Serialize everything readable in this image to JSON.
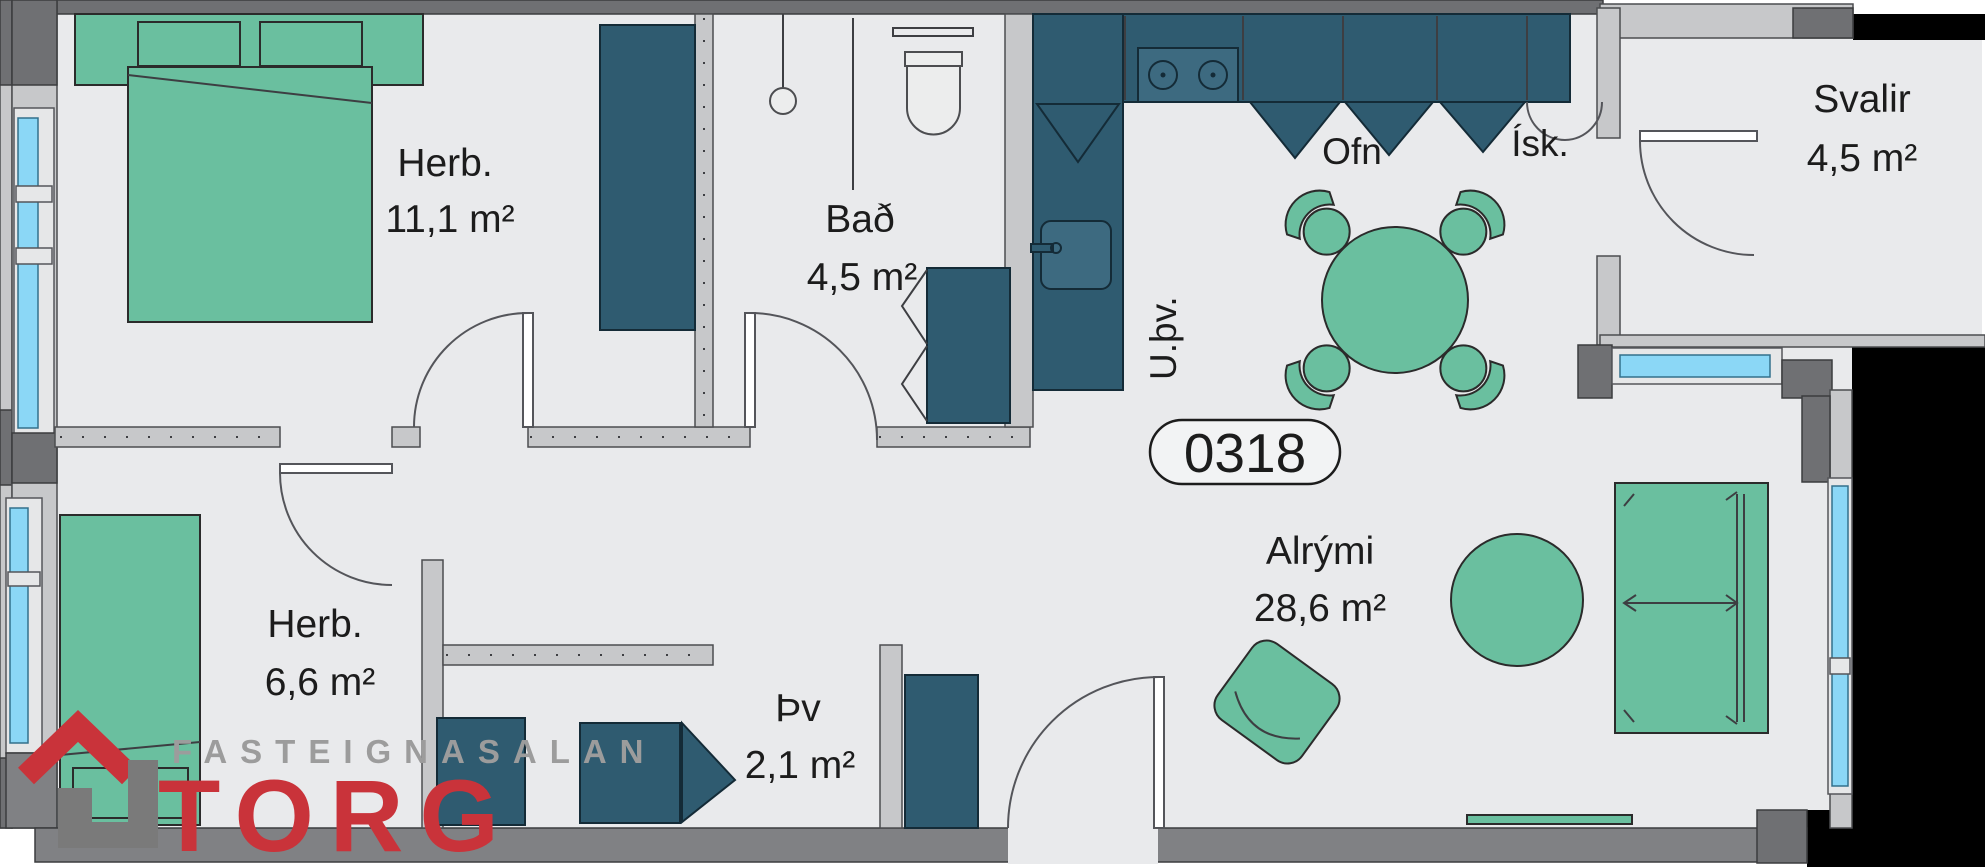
{
  "unit": {
    "number": "0318"
  },
  "rooms": {
    "bedroom1": {
      "label": "Herb.",
      "area": "11,1 m²"
    },
    "bedroom2": {
      "label": "Herb.",
      "area": "6,6 m²"
    },
    "bathroom": {
      "label": "Bað",
      "area": "4,5 m²"
    },
    "balcony": {
      "label": "Svalir",
      "area": "4,5 m²"
    },
    "living": {
      "label": "Alrými",
      "area": "28,6 m²"
    },
    "laundry": {
      "label": "Þv",
      "area": "2,1 m²"
    }
  },
  "kitchen": {
    "oven_label": "Ofn",
    "fridge_label": "Ísk.",
    "dishwasher_label": "U.þv."
  },
  "logo": {
    "agency_name": "FASTEIGNASALAN",
    "brand": "TORG"
  },
  "colors": {
    "floor": "#e9eaec",
    "wall_light": "#c7c8ca",
    "wall_dark": "#6f7073",
    "wall_mid": "#808184",
    "furniture_green": "#6abf9f",
    "cabinet_teal": "#2f5b70",
    "window_blue": "#8bd7f6",
    "logo_red": "#c9333a",
    "logo_gray": "#9c9c9c",
    "outside": "#000000"
  }
}
